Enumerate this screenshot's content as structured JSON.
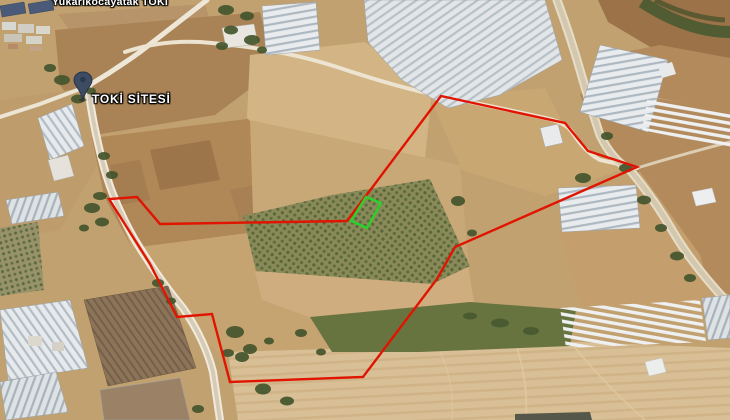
{
  "map": {
    "labels": {
      "area": "Yukarıkocayatak TOKİ",
      "site": "TOKİ SİTESİ"
    },
    "overlay": {
      "boundary_color": "#e01400",
      "plot_color": "#2bd12b",
      "pin_color": "#3d4c62"
    }
  }
}
